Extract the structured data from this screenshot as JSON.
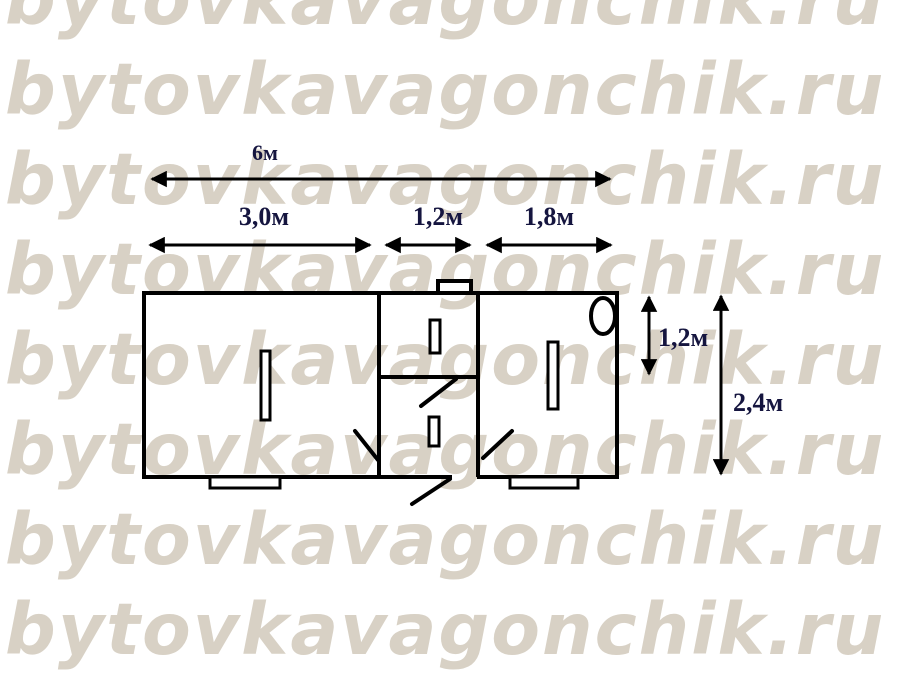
{
  "watermark": {
    "text": "bytovkavagonchik.ru",
    "color": "#d8d1c5",
    "row_count": 8
  },
  "floorplan": {
    "dimensions": {
      "total_length": "6м",
      "segment_left": "3,0м",
      "segment_middle": "1,2м",
      "segment_right": "1,8м",
      "height_upper": "1,2м",
      "height_total": "2,4м"
    },
    "colors": {
      "wall_line": "#000000",
      "dimension_label": "#15153f",
      "watermark": "#d8d1c5"
    },
    "fixtures": [
      "window-left-room",
      "window-middle-top",
      "window-middle-bottom",
      "window-right-room",
      "roof-vent",
      "washbasin-oval",
      "entry-step-left",
      "entry-step-right",
      "door-leaf-left-room",
      "door-leaf-middle-partition",
      "door-leaf-right-room",
      "door-leaf-entrance"
    ]
  }
}
